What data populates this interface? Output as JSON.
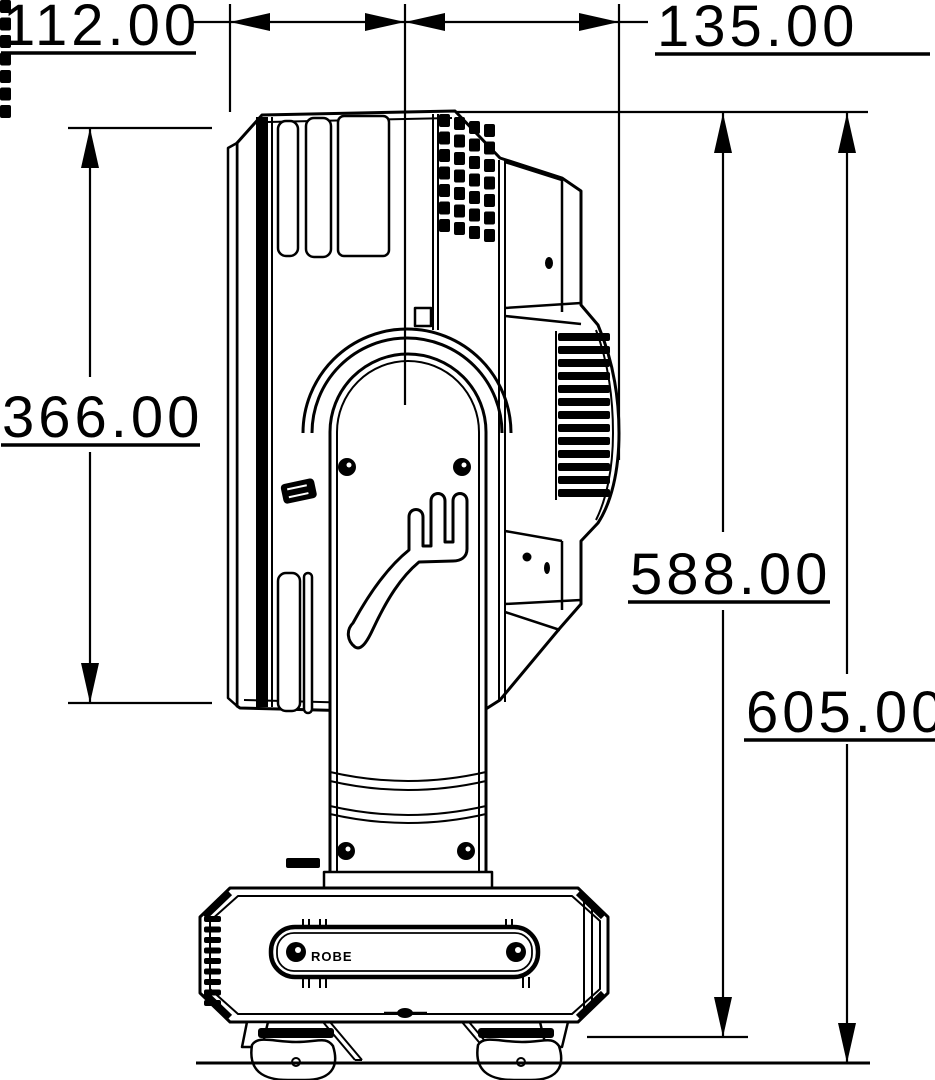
{
  "drawing": {
    "background": "#ffffff",
    "line_color": "#000000",
    "dimensions": {
      "rear_depth": "112.00",
      "front_depth": "135.00",
      "head_height": "366.00",
      "height_to_base_bottom": "588.00",
      "overall_height": "605.00"
    },
    "base_logo": "ROBE"
  }
}
